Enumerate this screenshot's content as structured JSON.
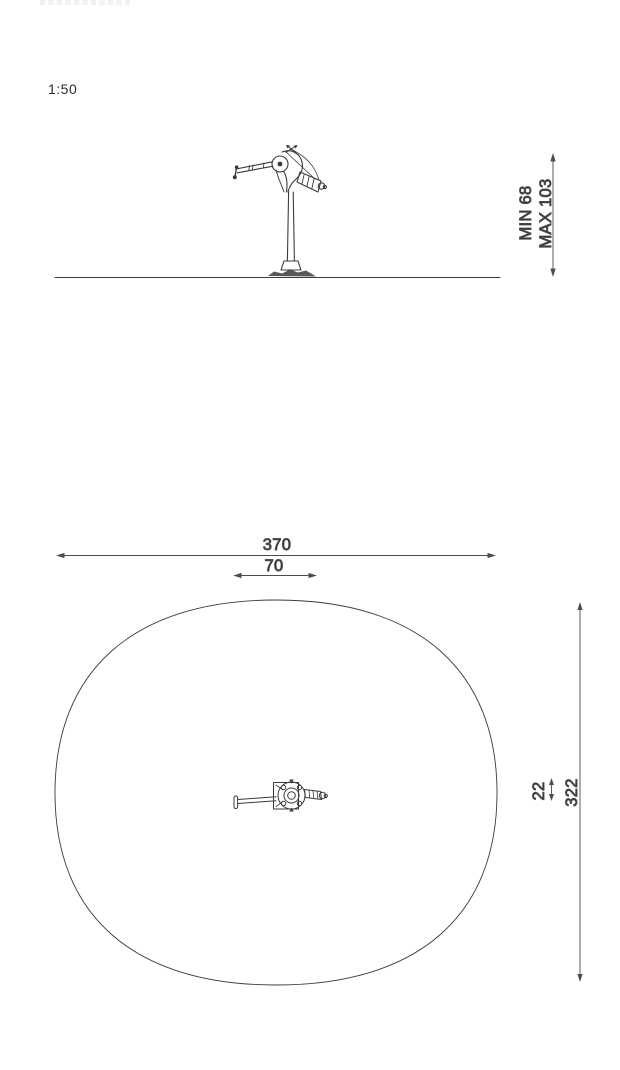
{
  "scale": {
    "label": "1:50"
  },
  "elevation_view": {
    "description_height_dimension": {
      "min": "MIN 68",
      "max": "MAX 103"
    }
  },
  "plan_view": {
    "dimensions": {
      "overall_width": "370",
      "handle_span": "70",
      "seat_width": "22",
      "overall_depth": "322"
    }
  },
  "colors": {
    "drawing_line": "#3b3b3b",
    "dimension_line": "#4d4d4d",
    "text": "#2a2a2a",
    "background": "#ffffff"
  }
}
